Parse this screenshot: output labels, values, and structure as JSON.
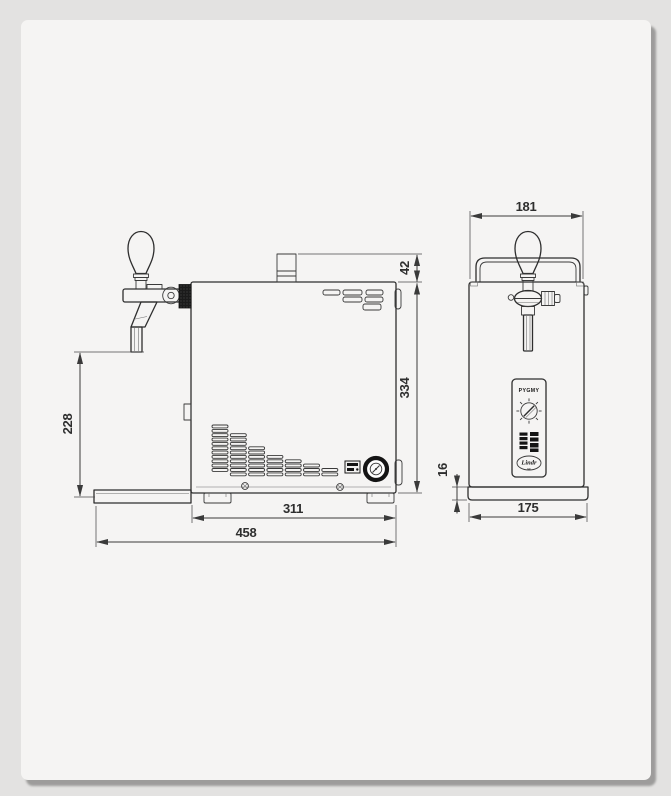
{
  "colors": {
    "background": "#e3e2e1",
    "card": "#f5f4f3",
    "line": "#2e2e2e",
    "dark_fill": "#141414"
  },
  "drawing": {
    "side_view": {
      "fitting_height_mm": "42",
      "body_height_mm": "334",
      "spout_height_mm": "228",
      "body_depth_mm": "311",
      "overall_depth_mm": "458"
    },
    "front_view": {
      "overall_width_mm": "181",
      "base_height_mm": "16",
      "base_width_mm": "175"
    },
    "panel": {
      "model": "PYGMY",
      "brand": "Lindr",
      "brand_sub": "cz"
    }
  }
}
